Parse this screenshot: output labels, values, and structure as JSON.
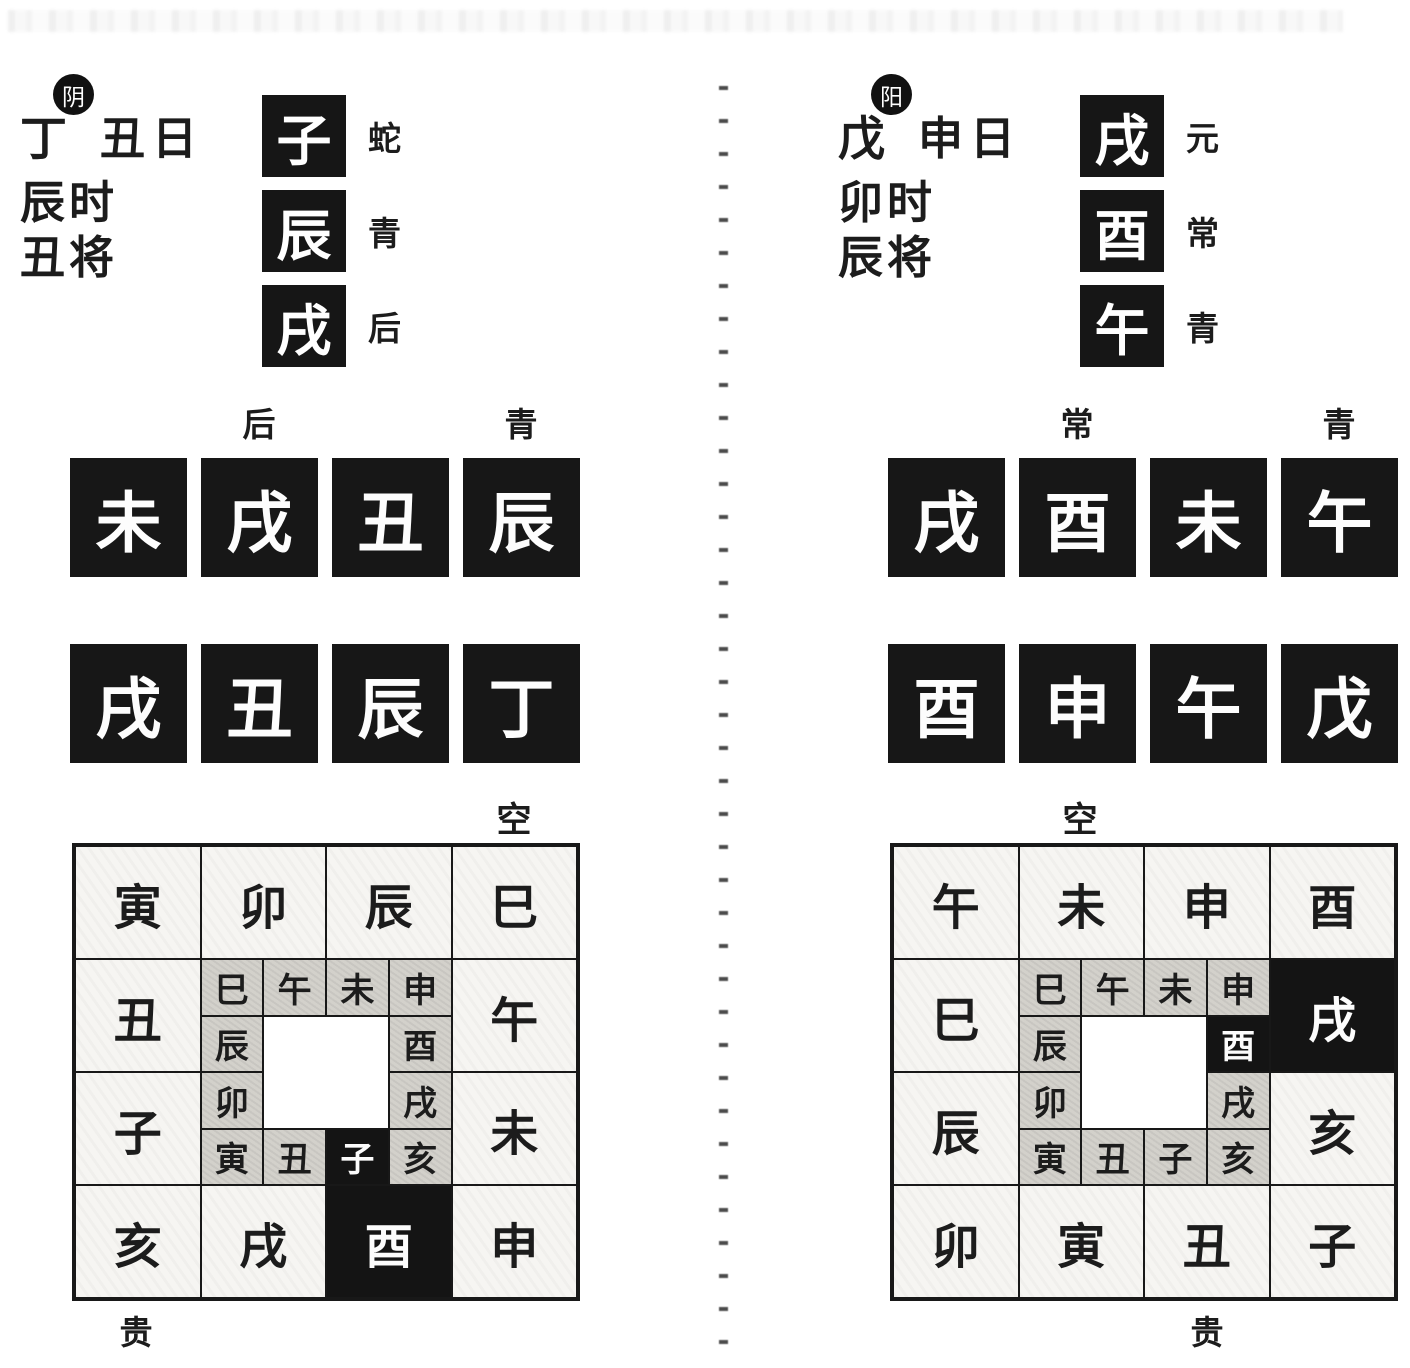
{
  "left_chart": {
    "badge": "阴",
    "stem": "丁",
    "day": "丑日",
    "hour": "辰时",
    "general": "丑将",
    "transmissions": [
      {
        "branch": "子",
        "deity": "蛇"
      },
      {
        "branch": "辰",
        "deity": "青"
      },
      {
        "branch": "戌",
        "deity": "后"
      }
    ],
    "lessons": {
      "label_left": "后",
      "label_right": "青",
      "row1": [
        "未",
        "戌",
        "丑",
        "辰"
      ],
      "row2": [
        "戌",
        "丑",
        "辰",
        "丁"
      ]
    },
    "plate": {
      "top_label": "空",
      "bottom_label": "贵",
      "outer_top": [
        "寅",
        "卯",
        "辰",
        "巳"
      ],
      "outer_left": [
        "丑",
        "子"
      ],
      "outer_right": [
        "午",
        "未"
      ],
      "outer_bottom": [
        "亥",
        "戌",
        "酉",
        "申"
      ],
      "inner_top": [
        "巳",
        "午",
        "未",
        "申"
      ],
      "inner_left": [
        "辰",
        "卯"
      ],
      "inner_right": [
        "酉",
        "戌"
      ],
      "inner_bottom": [
        "寅",
        "丑",
        "子",
        "亥"
      ],
      "highlighted_outer": "酉",
      "highlighted_inner": "子"
    }
  },
  "right_chart": {
    "badge": "阳",
    "stem": "戊",
    "day": "申日",
    "hour": "卯时",
    "general": "辰将",
    "transmissions": [
      {
        "branch": "戌",
        "deity": "元"
      },
      {
        "branch": "酉",
        "deity": "常"
      },
      {
        "branch": "午",
        "deity": "青"
      }
    ],
    "lessons": {
      "label_left": "常",
      "label_right": "青",
      "row1": [
        "戌",
        "酉",
        "未",
        "午"
      ],
      "row2": [
        "酉",
        "申",
        "午",
        "戊"
      ]
    },
    "plate": {
      "top_label": "空",
      "bottom_label": "贵",
      "outer_top": [
        "午",
        "未",
        "申",
        "酉"
      ],
      "outer_left": [
        "巳",
        "辰"
      ],
      "outer_right": [
        "戌",
        "亥"
      ],
      "outer_bottom": [
        "卯",
        "寅",
        "丑",
        "子"
      ],
      "inner_top": [
        "巳",
        "午",
        "未",
        "申"
      ],
      "inner_left": [
        "辰",
        "卯"
      ],
      "inner_right": [
        "酉",
        "戌"
      ],
      "inner_bottom": [
        "寅",
        "丑",
        "子",
        "亥"
      ],
      "highlighted_outer": "戌",
      "highlighted_inner": "酉"
    }
  }
}
